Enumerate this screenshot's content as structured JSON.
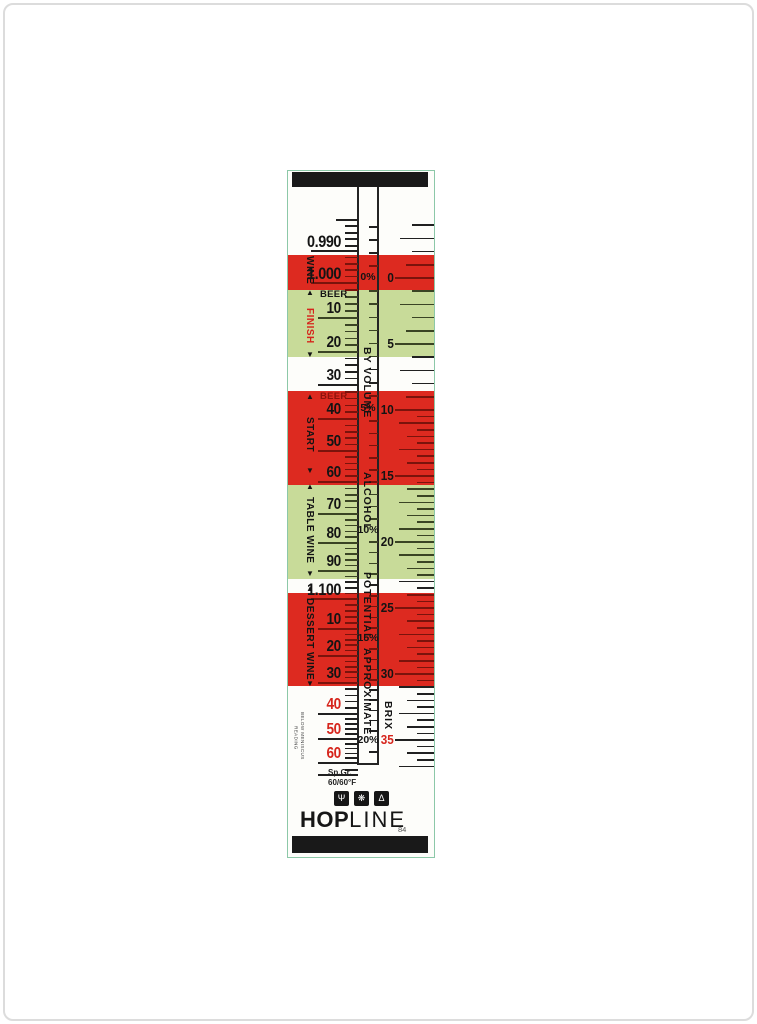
{
  "colors": {
    "red_band": "#dd2a20",
    "green_band": "#c8db99",
    "tick": "#202020",
    "tick_on_red": "#7a130c",
    "tick_on_green": "#3a4424",
    "num": "#141414",
    "red_text": "#d6251c",
    "dark_red_text": "#8c130c",
    "bar": "#191919"
  },
  "bands": [
    {
      "name": "wine-finish-band",
      "fill": "red",
      "y1": 84,
      "y2": 119
    },
    {
      "name": "beer-finish-band",
      "fill": "green",
      "y1": 119,
      "y2": 186
    },
    {
      "name": "beer-start-band",
      "fill": "red",
      "y1": 220,
      "y2": 314
    },
    {
      "name": "table-wine-band",
      "fill": "green",
      "y1": 314,
      "y2": 408
    },
    {
      "name": "dessert-wine-band",
      "fill": "red",
      "y1": 422,
      "y2": 515
    }
  ],
  "sg_scale": {
    "name": "specific-gravity-scale",
    "labels": [
      [
        "0.990",
        80,
        1,
        "num"
      ],
      [
        "1.000",
        112,
        1,
        "num"
      ],
      [
        "10",
        147,
        0,
        "num"
      ],
      [
        "20",
        181,
        0,
        "num"
      ],
      [
        "30",
        214,
        0,
        "num"
      ],
      [
        "40",
        248,
        0,
        "num"
      ],
      [
        "50",
        280,
        0,
        "num"
      ],
      [
        "60",
        311,
        0,
        "num"
      ],
      [
        "70",
        343,
        0,
        "num"
      ],
      [
        "80",
        372,
        0,
        "num"
      ],
      [
        "90",
        400,
        0,
        "num"
      ],
      [
        "1.100",
        428,
        1,
        "num"
      ],
      [
        "10",
        458,
        0,
        "num"
      ],
      [
        "20",
        485,
        0,
        "num"
      ],
      [
        "30",
        512,
        0,
        "num"
      ],
      [
        "40",
        543,
        0,
        "red_text"
      ],
      [
        "50",
        568,
        0,
        "red_text"
      ],
      [
        "60",
        592,
        0,
        "red_text"
      ]
    ],
    "top_minor_ticks": [
      74,
      67,
      61,
      54
    ],
    "top_medium_ticks": [
      48
    ],
    "bottom_minor_ticks": [
      598
    ],
    "end_line_y": 603
  },
  "percent_scale": {
    "name": "potential-alcohol-scale",
    "labels": [
      [
        "0%",
        107
      ],
      [
        "5%",
        238
      ],
      [
        "10%",
        360
      ],
      [
        "15%",
        468
      ],
      [
        "20%",
        570
      ]
    ],
    "top_ticks": [
      94,
      81,
      68,
      55
    ],
    "bottom_ticks": [
      580
    ],
    "words": [
      [
        "BY VOLUME",
        156,
        268
      ],
      [
        "ALCOHOL",
        282,
        378
      ],
      [
        "POTENTIAL",
        390,
        480
      ],
      [
        "APPROXIMATE",
        480,
        562
      ]
    ],
    "close_y": 592
  },
  "brix_scale": {
    "name": "brix-scale",
    "title": "BRIX",
    "title_y1": 531,
    "title_y2": 558,
    "origin_y": 107,
    "px_per_unit": 13.2,
    "unit_tick_range": [
      -4,
      9
    ],
    "half_tick_range": [
      10.5,
      37
    ],
    "labels": [
      [
        "0",
        107,
        "num"
      ],
      [
        "5",
        173,
        "num"
      ],
      [
        "10",
        239,
        "num"
      ],
      [
        "15",
        305,
        "num"
      ],
      [
        "20",
        371,
        "num"
      ],
      [
        "25",
        437,
        "num"
      ],
      [
        "30",
        503,
        "num"
      ],
      [
        "35",
        569,
        "red_text"
      ]
    ]
  },
  "band_labels": [
    {
      "name": "wine-label",
      "text": "WINE",
      "y1": 82,
      "y2": 116,
      "color": "num",
      "arrows": []
    },
    {
      "name": "finish-label",
      "text": "FINISH",
      "y1": 131,
      "y2": 178,
      "color": "red_text",
      "arrows": [
        123,
        185
      ]
    },
    {
      "name": "start-label",
      "text": "START",
      "y1": 235,
      "y2": 292,
      "color": "num",
      "arrows": [
        227,
        301
      ]
    },
    {
      "name": "table-wine-label",
      "text": "TABLE WINE",
      "y1": 322,
      "y2": 397,
      "color": "num",
      "arrows": [
        317,
        404
      ]
    },
    {
      "name": "dessert-wine-label",
      "text": "DESSERT WINE",
      "y1": 426,
      "y2": 510,
      "color": "num",
      "arrows": [
        419,
        514
      ]
    }
  ],
  "beer_labels": [
    {
      "text": "BEER",
      "y": 123,
      "color": "num"
    },
    {
      "text": "BEER",
      "y": 225,
      "color": "dark_red_text"
    }
  ],
  "footer": {
    "meniscus_line1": "READING",
    "meniscus_line2": "BELOW MENISCUS",
    "spgr_line1": "Sp.Gr.",
    "spgr_line2": "60/60°F",
    "icons": [
      {
        "name": "wheat-icon",
        "glyph": "Ψ"
      },
      {
        "name": "gear-icon",
        "glyph": "❋"
      },
      {
        "name": "flask-icon",
        "glyph": "Δ"
      }
    ],
    "brand_bold": "HOP",
    "brand_light": "LINE",
    "code": "84"
  }
}
